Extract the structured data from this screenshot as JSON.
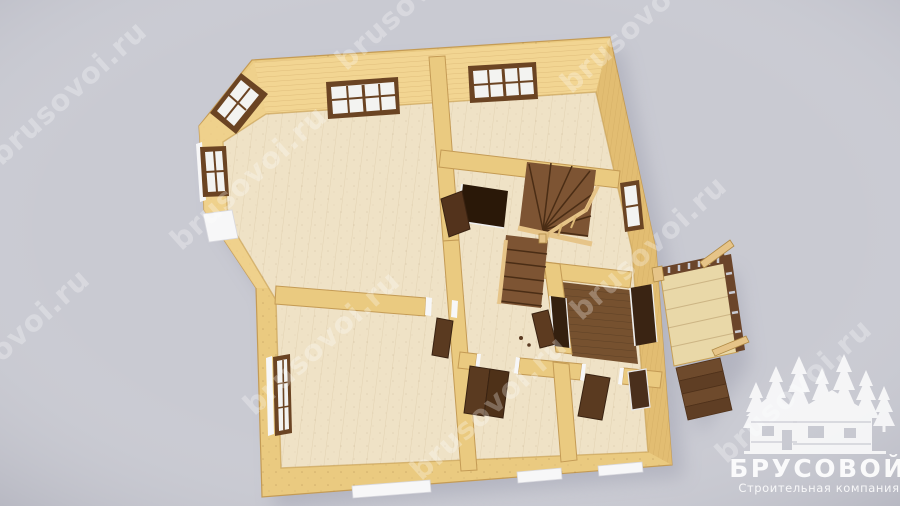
{
  "scene": {
    "description": "3D top-down render of a single-storey wooden log house floor plan",
    "rooms_visible": 7,
    "elements": [
      "corner bay with windows",
      "winder staircase",
      "entry room with dark floor",
      "side porch with railing and steps",
      "open interior doors",
      "white window sills"
    ]
  },
  "watermark": {
    "text": "brusovoi.ru",
    "repetitions": 9,
    "color": "#ffffff"
  },
  "logo": {
    "title": "БРУСОВОЙ",
    "subtitle": "Строительная компания",
    "graphic": "log-house-with-fir-trees",
    "color": "#ffffff"
  },
  "palette": {
    "background": "#c9cad2",
    "wall_top": "#eaca80",
    "wall_face_light": "#f2d592",
    "wall_face_shade": "#e2bd72",
    "wall_edge": "#c49b55",
    "floor": "#efe2c6",
    "floor_dark": "#76512f",
    "stair_wood": "#7d5433",
    "stair_line": "#4a2d15",
    "door_dark": "#5a3a20",
    "door_opening": "#2a1808",
    "window_frame": "#6b4423",
    "glass": "#f3f3f1",
    "trim_white": "#f7f7f8",
    "porch_deck": "#e9d8a8",
    "railing_dark": "#6b452a",
    "handrail_light": "#e6c488",
    "shadow": "#8c8da0"
  }
}
